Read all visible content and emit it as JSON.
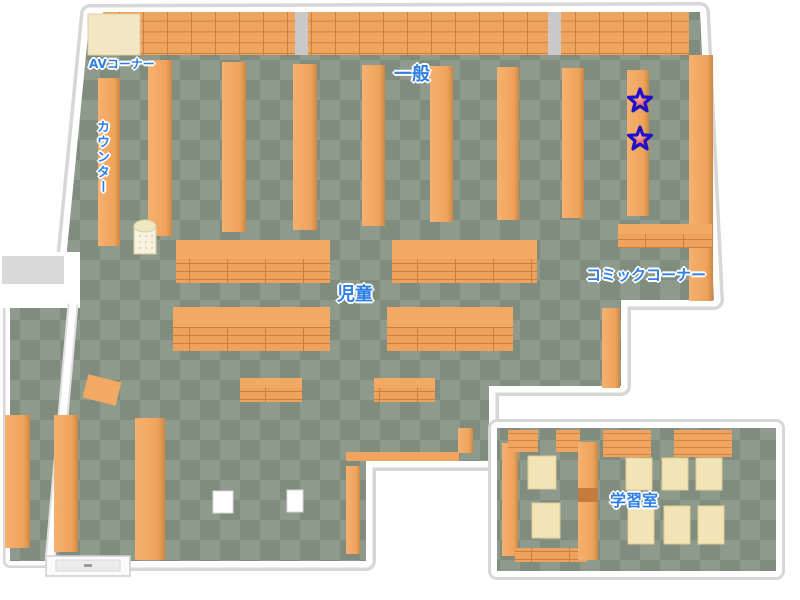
{
  "areas": {
    "av_corner": {
      "label": "AVコーナー"
    },
    "counter": {
      "label": "カウンター"
    },
    "general": {
      "label": "一般"
    },
    "children": {
      "label": "児童"
    },
    "comic_corner": {
      "label": "コミックコーナー"
    },
    "study_room": {
      "label": "学習室"
    }
  },
  "markers": {
    "stars": [
      {
        "name": "star-marker-1",
        "transform": "translate(640,101)"
      },
      {
        "name": "star-marker-2",
        "transform": "translate(640,139)"
      }
    ]
  },
  "colors": {
    "floor_light": "#8E9B8C",
    "floor_dark": "#7F8C7E",
    "wall": "#FFFFFF",
    "wall_edge": "#D7D7D7",
    "pillar_gray": "#C9C9C9",
    "shelf_face": "#F2A660",
    "shelf_edge": "#D08746",
    "shelf_line": "#C9803F",
    "counter_cream": "#F3E7C3",
    "table_cream": "#F3E4B8",
    "label_blue": "#2E7FE6",
    "star_red": "#E23C38",
    "star_outline": "#1B13C8"
  }
}
